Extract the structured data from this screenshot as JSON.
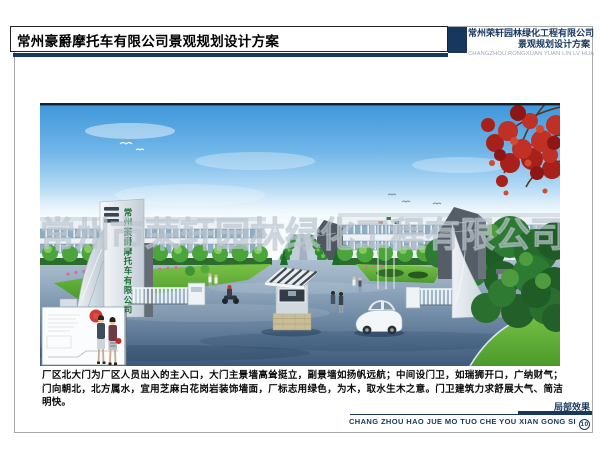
{
  "header": {
    "title": "常州豪爵摩托车有限公司景观规划设计方案",
    "right_company": "常州荣轩园林绿化工程有限公司",
    "right_subtitle": "景观规划设计方案",
    "right_pinyin": "CHANGZHOU RONGXUAN YUAN LIN LV HUA",
    "accent_color": "#17375e"
  },
  "render": {
    "gate_sign": "常州豪爵摩托车有限公司",
    "watermark": "常州市荣轩园林绿化工程有限公司",
    "scene": "factory north gate entrance rendering: blue sky, red maple upper-right, white factory buildings, central guard kiosk, sail-shaped gate walls, lawns and trees, white car, site-plan inset with red stamp"
  },
  "caption": {
    "paragraph": "厂区北大门为厂区人员出入的主入口，大门主景墙高耸挺立，副景墙如扬帆远航；中间设门卫，如瑞狮开口，广纳财气；门向朝北，北方属水，宜用芝麻白花岗岩装饰墙面，厂标志用绿色，为木，取水生木之意。门卫建筑力求舒展大气、简洁明快。"
  },
  "footer": {
    "label": "局部效果",
    "pinyin": "CHANG ZHOU HAO JUE MO TUO CHE YOU XIAN GONG SI",
    "sheet_number": "10"
  }
}
